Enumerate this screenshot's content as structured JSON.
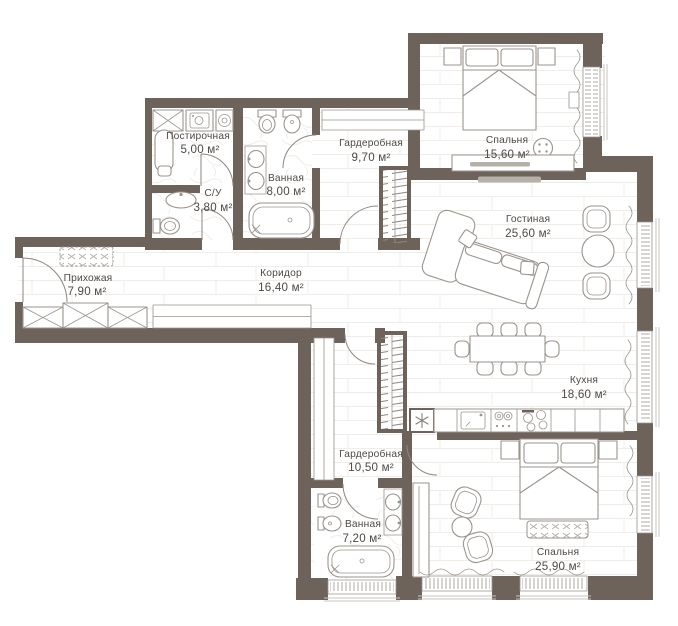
{
  "plan": {
    "title": "apartment-floor-plan",
    "rooms": [
      {
        "id": "laundry",
        "name": "Постирочная",
        "area": "5,00 м²"
      },
      {
        "id": "wc",
        "name": "С/У",
        "area": "3,80 м²"
      },
      {
        "id": "bathroom-1",
        "name": "Ванная",
        "area": "8,00 м²"
      },
      {
        "id": "wardrobe-1",
        "name": "Гардеробная",
        "area": "9,70 м²"
      },
      {
        "id": "bedroom-1",
        "name": "Спальня",
        "area": "15,60 м²"
      },
      {
        "id": "living-room",
        "name": "Гостиная",
        "area": "25,60 м²"
      },
      {
        "id": "hallway",
        "name": "Прихожая",
        "area": "7,90 м²"
      },
      {
        "id": "corridor",
        "name": "Коридор",
        "area": "16,40 м²"
      },
      {
        "id": "kitchen",
        "name": "Кухня",
        "area": "18,60 м²"
      },
      {
        "id": "wardrobe-2",
        "name": "Гардеробная",
        "area": "10,50 м²"
      },
      {
        "id": "bathroom-2",
        "name": "Ванная",
        "area": "7,20 м²"
      },
      {
        "id": "bedroom-2",
        "name": "Спальня",
        "area": "25,90 м²"
      }
    ],
    "colors": {
      "wall": "#6e635b",
      "fixture_line": "#9a948d",
      "text": "#4e4944",
      "floor": "#ffffff",
      "plank_line": "#f0ece7"
    }
  }
}
